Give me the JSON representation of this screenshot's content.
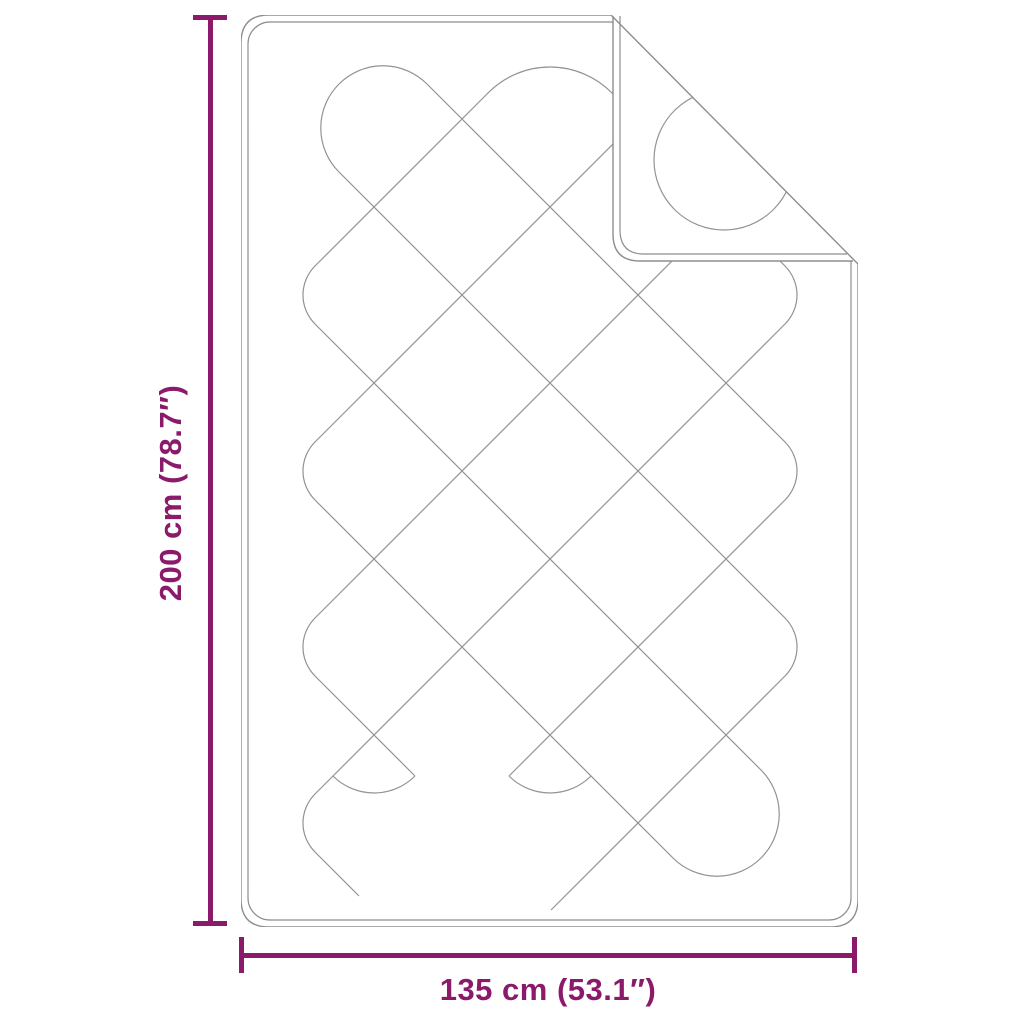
{
  "diagram": {
    "height_label": "200 cm (78.7″)",
    "width_label": "135 cm (53.1″)",
    "accent_color": "#8B1A6B",
    "line_color": "#8E8E8E"
  }
}
